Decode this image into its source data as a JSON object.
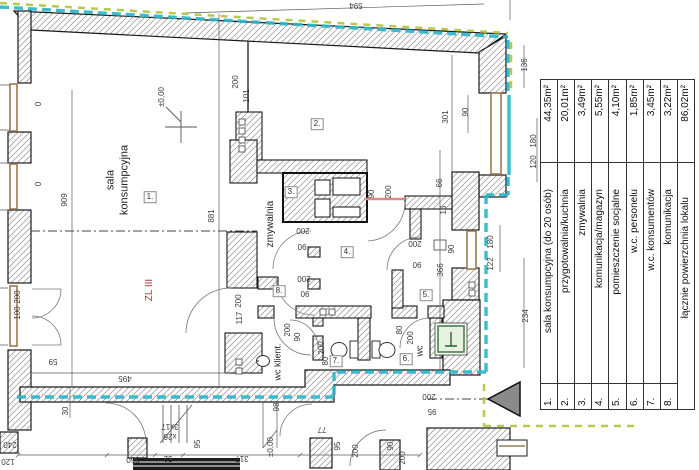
{
  "legend": {
    "rows": [
      {
        "no": "1.",
        "name": "sala konsumpcyjna (do 20 osób)",
        "area": "44,35m²"
      },
      {
        "no": "2.",
        "name": "przygotowalnia/kuchnia",
        "area": "20,01m²"
      },
      {
        "no": "3.",
        "name": "zmywalnia",
        "area": "3,49m²"
      },
      {
        "no": "4.",
        "name": "komunikacja/magazyn",
        "area": "5,55m²"
      },
      {
        "no": "5.",
        "name": "pomieszczenie socjalne",
        "area": "4,10m²"
      },
      {
        "no": "6.",
        "name": "w.c. personelu",
        "area": "1,85m²"
      },
      {
        "no": "7.",
        "name": "w.c. konsumentów",
        "area": "3,45m²"
      },
      {
        "no": "8.",
        "name": "komunikacja",
        "area": "3,22m²"
      }
    ],
    "total": {
      "name": "łącznie powierzchnia lokalu",
      "area": "86,02m²"
    }
  },
  "plan": {
    "rooms": [
      {
        "n": "1.",
        "x": 150,
        "y": 197
      },
      {
        "n": "2.",
        "x": 317,
        "y": 124
      },
      {
        "n": "3.",
        "x": 291,
        "y": 192
      },
      {
        "n": "4.",
        "x": 347,
        "y": 252
      },
      {
        "n": "5.",
        "x": 426,
        "y": 295
      },
      {
        "n": "6.",
        "x": 406,
        "y": 359
      },
      {
        "n": "7.",
        "x": 336,
        "y": 361
      },
      {
        "n": "8.",
        "x": 279,
        "y": 291
      }
    ],
    "texts": [
      {
        "t": "sala",
        "x": 111,
        "y": 180,
        "r": -90,
        "fs": 11
      },
      {
        "t": "konsumpcyjna",
        "x": 125,
        "y": 180,
        "r": -90,
        "fs": 11
      },
      {
        "t": "zmywalnia",
        "x": 271,
        "y": 224,
        "r": -90,
        "fs": 10
      },
      {
        "t": "ZL III",
        "x": 150,
        "y": 290,
        "r": -90,
        "fs": 10,
        "c": "#b2342e"
      },
      {
        "t": "wc",
        "x": 420,
        "y": 351,
        "r": -90,
        "fs": 9
      },
      {
        "t": "wc klient.",
        "x": 278,
        "y": 362,
        "r": -90,
        "fs": 9
      }
    ],
    "dims": [
      {
        "t": "594",
        "x": 356,
        "y": 5,
        "r": 180
      },
      {
        "t": "200",
        "x": 236,
        "y": 82,
        "r": -90
      },
      {
        "t": "101",
        "x": 247,
        "y": 96,
        "r": -90
      },
      {
        "t": "909",
        "x": 65,
        "y": 200,
        "r": -90
      },
      {
        "t": "881",
        "x": 212,
        "y": 216,
        "r": -90
      },
      {
        "t": "±0,00",
        "x": 162,
        "y": 97,
        "r": -90
      },
      {
        "t": "0",
        "x": 39,
        "y": 104,
        "r": -90
      },
      {
        "t": "0",
        "x": 39,
        "y": 184,
        "r": -90
      },
      {
        "t": "200",
        "x": 18,
        "y": 297,
        "r": -90
      },
      {
        "t": "100",
        "x": 18,
        "y": 313,
        "r": -90
      },
      {
        "t": "59",
        "x": 53,
        "y": 361,
        "r": 180
      },
      {
        "t": "495",
        "x": 125,
        "y": 378,
        "r": 180
      },
      {
        "t": "30",
        "x": 66,
        "y": 411,
        "r": -90
      },
      {
        "t": "240",
        "x": 10,
        "y": 444,
        "r": 180
      },
      {
        "t": "120",
        "x": 8,
        "y": 461,
        "r": 180
      },
      {
        "t": "95",
        "x": 198,
        "y": 444,
        "r": -90
      },
      {
        "t": "360",
        "x": 133,
        "y": 459,
        "r": 180
      },
      {
        "t": "52",
        "x": 168,
        "y": 458,
        "r": 180
      },
      {
        "t": "317",
        "x": 242,
        "y": 458,
        "r": 180
      },
      {
        "t": "3x17",
        "x": 170,
        "y": 426,
        "r": 180
      },
      {
        "t": "x26",
        "x": 170,
        "y": 436,
        "r": 180
      },
      {
        "t": "±0,00",
        "x": 271,
        "y": 447,
        "r": -90
      },
      {
        "t": "98",
        "x": 277,
        "y": 407,
        "r": -90
      },
      {
        "t": "77",
        "x": 322,
        "y": 429,
        "r": 180
      },
      {
        "t": "95",
        "x": 338,
        "y": 446,
        "r": -90
      },
      {
        "t": "200",
        "x": 356,
        "y": 451,
        "r": -90
      },
      {
        "t": "90",
        "x": 391,
        "y": 446,
        "r": -90
      },
      {
        "t": "200",
        "x": 403,
        "y": 458,
        "r": -90
      },
      {
        "t": "200",
        "x": 429,
        "y": 396,
        "r": 180
      },
      {
        "t": "95",
        "x": 432,
        "y": 411,
        "r": 180
      },
      {
        "t": "117",
        "x": 240,
        "y": 318,
        "r": -90
      },
      {
        "t": "200",
        "x": 239,
        "y": 301,
        "r": -90
      },
      {
        "t": "200",
        "x": 288,
        "y": 330,
        "r": -90
      },
      {
        "t": "90",
        "x": 298,
        "y": 337,
        "r": -90
      },
      {
        "t": "200",
        "x": 322,
        "y": 348,
        "r": -90
      },
      {
        "t": "80",
        "x": 326,
        "y": 361,
        "r": -90
      },
      {
        "t": "200",
        "x": 303,
        "y": 230,
        "r": 180
      },
      {
        "t": "90",
        "x": 302,
        "y": 246,
        "r": 180
      },
      {
        "t": "200",
        "x": 304,
        "y": 278,
        "r": 180
      },
      {
        "t": "90",
        "x": 305,
        "y": 293,
        "r": 180
      },
      {
        "t": "90",
        "x": 372,
        "y": 194,
        "r": -90
      },
      {
        "t": "200",
        "x": 389,
        "y": 192,
        "r": -90
      },
      {
        "t": "200",
        "x": 415,
        "y": 243,
        "r": 180
      },
      {
        "t": "90",
        "x": 417,
        "y": 264,
        "r": 180
      },
      {
        "t": "80",
        "x": 400,
        "y": 330,
        "r": -90
      },
      {
        "t": "200",
        "x": 411,
        "y": 338,
        "r": -90
      },
      {
        "t": "66",
        "x": 440,
        "y": 183,
        "r": -90
      },
      {
        "t": "16",
        "x": 444,
        "y": 210,
        "r": -90
      },
      {
        "t": "366",
        "x": 441,
        "y": 270,
        "r": -90
      },
      {
        "t": "90",
        "x": 452,
        "y": 249,
        "r": -90
      },
      {
        "t": "301",
        "x": 446,
        "y": 117,
        "r": -90
      },
      {
        "t": "90",
        "x": 466,
        "y": 112,
        "r": -90
      },
      {
        "t": "136",
        "x": 525,
        "y": 65,
        "r": -90
      },
      {
        "t": "180",
        "x": 534,
        "y": 141,
        "r": -90
      },
      {
        "t": "120",
        "x": 534,
        "y": 162,
        "r": -90
      },
      {
        "t": "180",
        "x": 491,
        "y": 242,
        "r": -90
      },
      {
        "t": "122",
        "x": 491,
        "y": 264,
        "r": -90
      },
      {
        "t": "234",
        "x": 526,
        "y": 316,
        "r": -90
      }
    ]
  },
  "colors": {
    "boundary_cyan": "#2eb5c9",
    "boundary_lime": "#b9c94f",
    "fire_zone_red": "#b2342e",
    "door_red": "#dc8a8a",
    "window_brown": "#9c7a55",
    "electric_green": "#47824a",
    "wall_hatch": "#8f8f8f"
  }
}
